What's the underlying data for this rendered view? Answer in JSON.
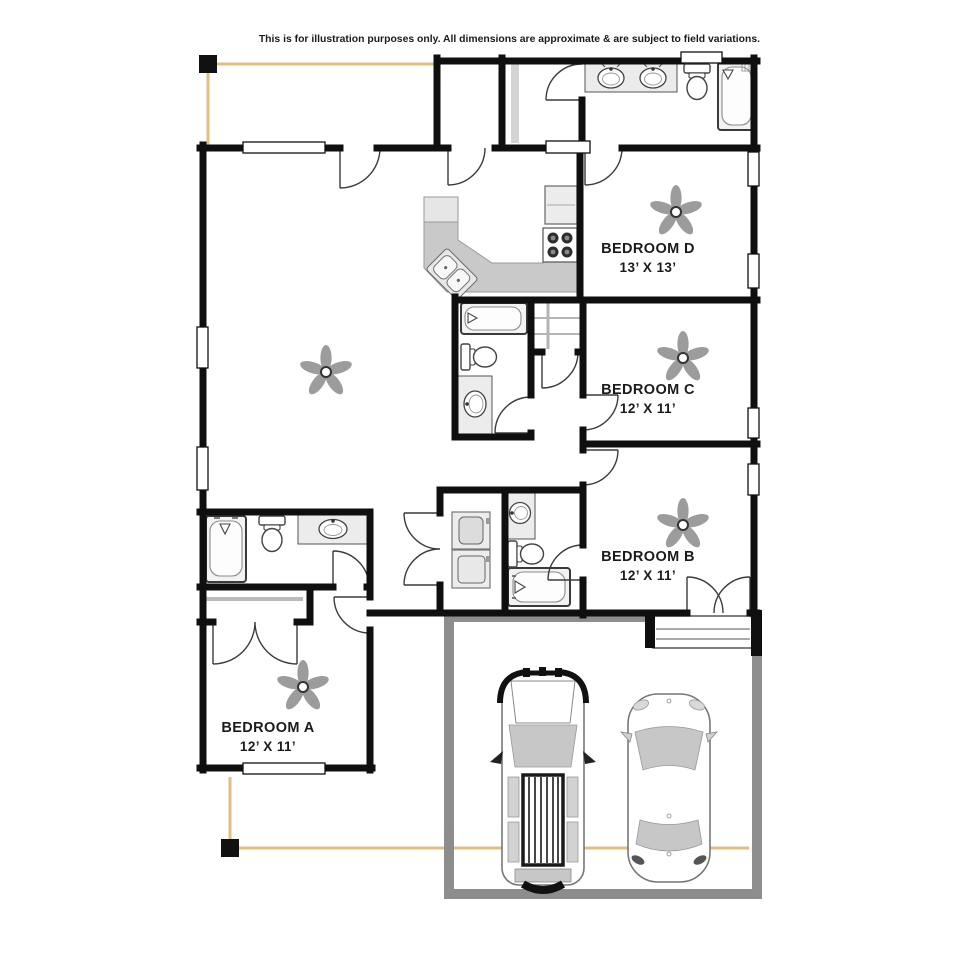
{
  "disclaimer": "This is for illustration purposes only. All dimensions are approximate & are subject to field variations.",
  "rooms": {
    "bedroom_d": {
      "name": "BEDROOM D",
      "dims": "13’ X 13’"
    },
    "bedroom_c": {
      "name": "BEDROOM C",
      "dims": "12’ X 11’"
    },
    "bedroom_b": {
      "name": "BEDROOM B",
      "dims": "12’ X 11’"
    },
    "bedroom_a": {
      "name": "BEDROOM A",
      "dims": "12’ X 11’"
    }
  },
  "colors": {
    "wall": "#0f0f0f",
    "porch": "#dfbe8a",
    "garage_wall": "#8d8d8d",
    "counter": "#c9c9c9",
    "counter_light": "#e6e6e6",
    "fixture_fill": "#f2f2f2",
    "fixture_stroke": "#3a3a3a",
    "fan": "#9c9c9c",
    "glass": "#c7c7c7"
  },
  "fixtures": {
    "icons": [
      "ceiling-fan",
      "bathtub",
      "toilet",
      "sink-vanity",
      "double-vanity",
      "washer-dryer-stack",
      "range",
      "refrigerator",
      "corner-sink",
      "pickup-truck",
      "sedan-car",
      "porch-post",
      "exterior-step"
    ]
  }
}
